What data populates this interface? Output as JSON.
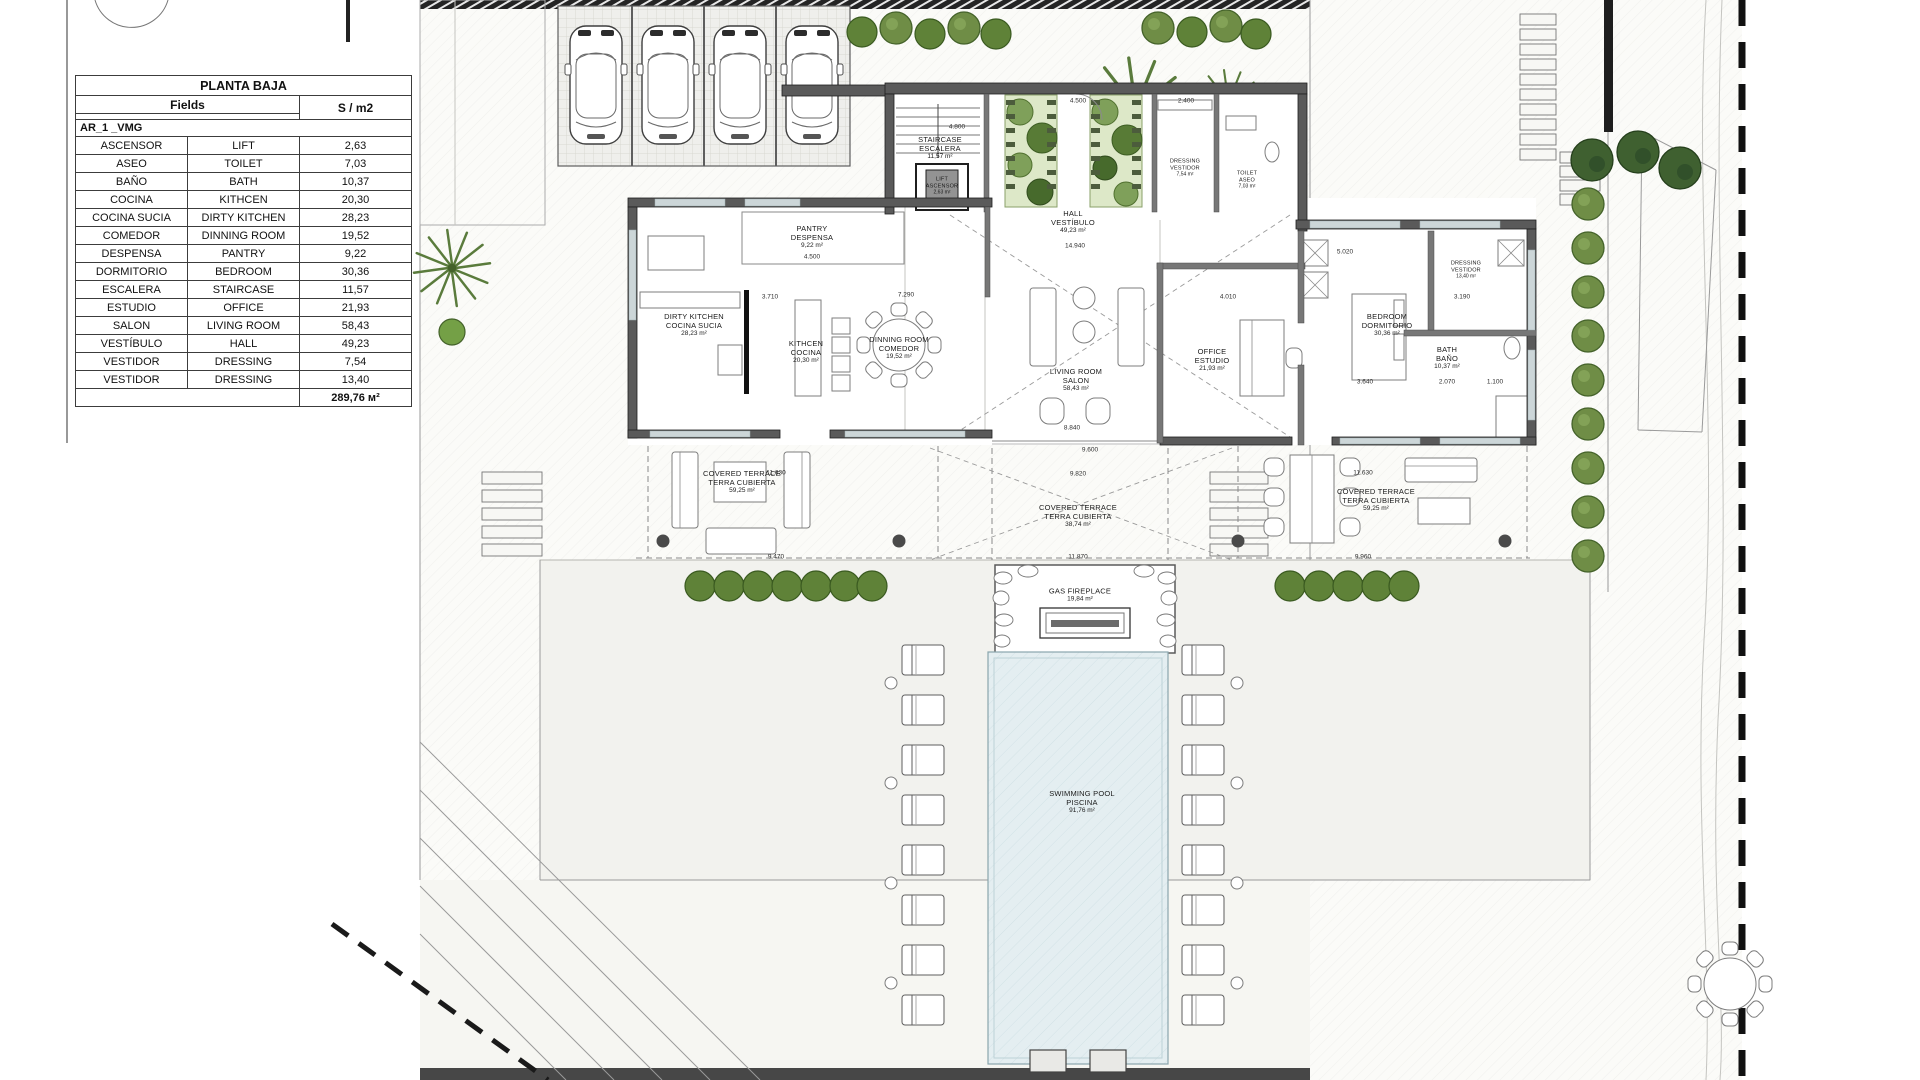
{
  "table": {
    "title": "PLANTA BAJA",
    "fields_header": "Fields",
    "unit_header": "S / m2",
    "group": "AR_1 _VMG",
    "rows": [
      {
        "es": "ASCENSOR",
        "en": "LIFT",
        "v": "2,63"
      },
      {
        "es": "ASEO",
        "en": "TOILET",
        "v": "7,03"
      },
      {
        "es": "BAÑO",
        "en": "BATH",
        "v": "10,37"
      },
      {
        "es": "COCINA",
        "en": "KITHCEN",
        "v": "20,30"
      },
      {
        "es": "COCINA SUCIA",
        "en": "DIRTY KITCHEN",
        "v": "28,23"
      },
      {
        "es": "COMEDOR",
        "en": "DINNING ROOM",
        "v": "19,52"
      },
      {
        "es": "DESPENSA",
        "en": "PANTRY",
        "v": "9,22"
      },
      {
        "es": "DORMITORIO",
        "en": "BEDROOM",
        "v": "30,36"
      },
      {
        "es": "ESCALERA",
        "en": "STAIRCASE",
        "v": "11,57"
      },
      {
        "es": "ESTUDIO",
        "en": "OFFICE",
        "v": "21,93"
      },
      {
        "es": "SALON",
        "en": "LIVING ROOM",
        "v": "58,43"
      },
      {
        "es": "VESTÍBULO",
        "en": "HALL",
        "v": "49,23"
      },
      {
        "es": "VESTIDOR",
        "en": "DRESSING",
        "v": "7,54"
      },
      {
        "es": "VESTIDOR",
        "en": "DRESSING",
        "v": "13,40"
      }
    ],
    "total": "289,76 м²"
  },
  "plan": {
    "rooms": [
      {
        "en": "STAIRCASE",
        "es": "ESCALERA",
        "area": "11,57 m²"
      },
      {
        "en": "LIFT",
        "es": "ASCENSOR",
        "area": "2,63 m²"
      },
      {
        "en": "DRESSING",
        "es": "VESTIDOR",
        "area": "7,54 m²"
      },
      {
        "en": "TOILET",
        "es": "ASEO",
        "area": "7,03 m²"
      },
      {
        "en": "HALL",
        "es": "VESTÍBULO",
        "area": "49,23 m²"
      },
      {
        "en": "PANTRY",
        "es": "DESPENSA",
        "area": "9,22 m²"
      },
      {
        "en": "DIRTY KITCHEN",
        "es": "COCINA SUCIA",
        "area": "28,23 m²"
      },
      {
        "en": "KITHCEN",
        "es": "COCINA",
        "area": "20,30 m²"
      },
      {
        "en": "DINNING ROOM",
        "es": "COMEDOR",
        "area": "19,52 m²"
      },
      {
        "en": "LIVING ROOM",
        "es": "SALON",
        "area": "58,43 m²"
      },
      {
        "en": "OFFICE",
        "es": "ESTUDIO",
        "area": "21,93 m²"
      },
      {
        "en": "BEDROOM",
        "es": "DORMITORIO",
        "area": "30,36 m²"
      },
      {
        "en": "BATH",
        "es": "BAÑO",
        "area": "10,37 m²"
      },
      {
        "en": "DRESSING",
        "es": "VESTIDOR",
        "area": "13,40 m²"
      },
      {
        "en": "COVERED TERRACE",
        "es": "TERRA CUBIERTA",
        "area": "59,25 m²"
      },
      {
        "en": "COVERED TERRACE",
        "es": "TERRA CUBIERTA",
        "area": "38,74 m²"
      },
      {
        "en": "COVERED TERRACE",
        "es": "TERRA CUBIERTA",
        "area": "59,25 m²"
      },
      {
        "en": "GAS FIREPLACE",
        "es": "",
        "area": "19,84 m²"
      },
      {
        "en": "SWIMMING POOL",
        "es": "PISCINA",
        "area": "91,76 m²"
      }
    ],
    "dims": [
      "4.800",
      "4.500",
      "2.400",
      "14.940",
      "3.710",
      "7.290",
      "4.500",
      "5.020",
      "4.010",
      "8.840",
      "9.600",
      "11.630",
      "9.470",
      "9.820",
      "11.870",
      "11.630",
      "9.960",
      "3.190",
      "3.640",
      "2.070",
      "1.100"
    ]
  },
  "colors": {
    "wall": "#5a5a5a",
    "pool": "#e4eef1",
    "vegetation": "#6f8d46",
    "vegetation_dark": "#3f6030",
    "paving": "#f2f2ee",
    "boundary": "#1a1a1a"
  }
}
